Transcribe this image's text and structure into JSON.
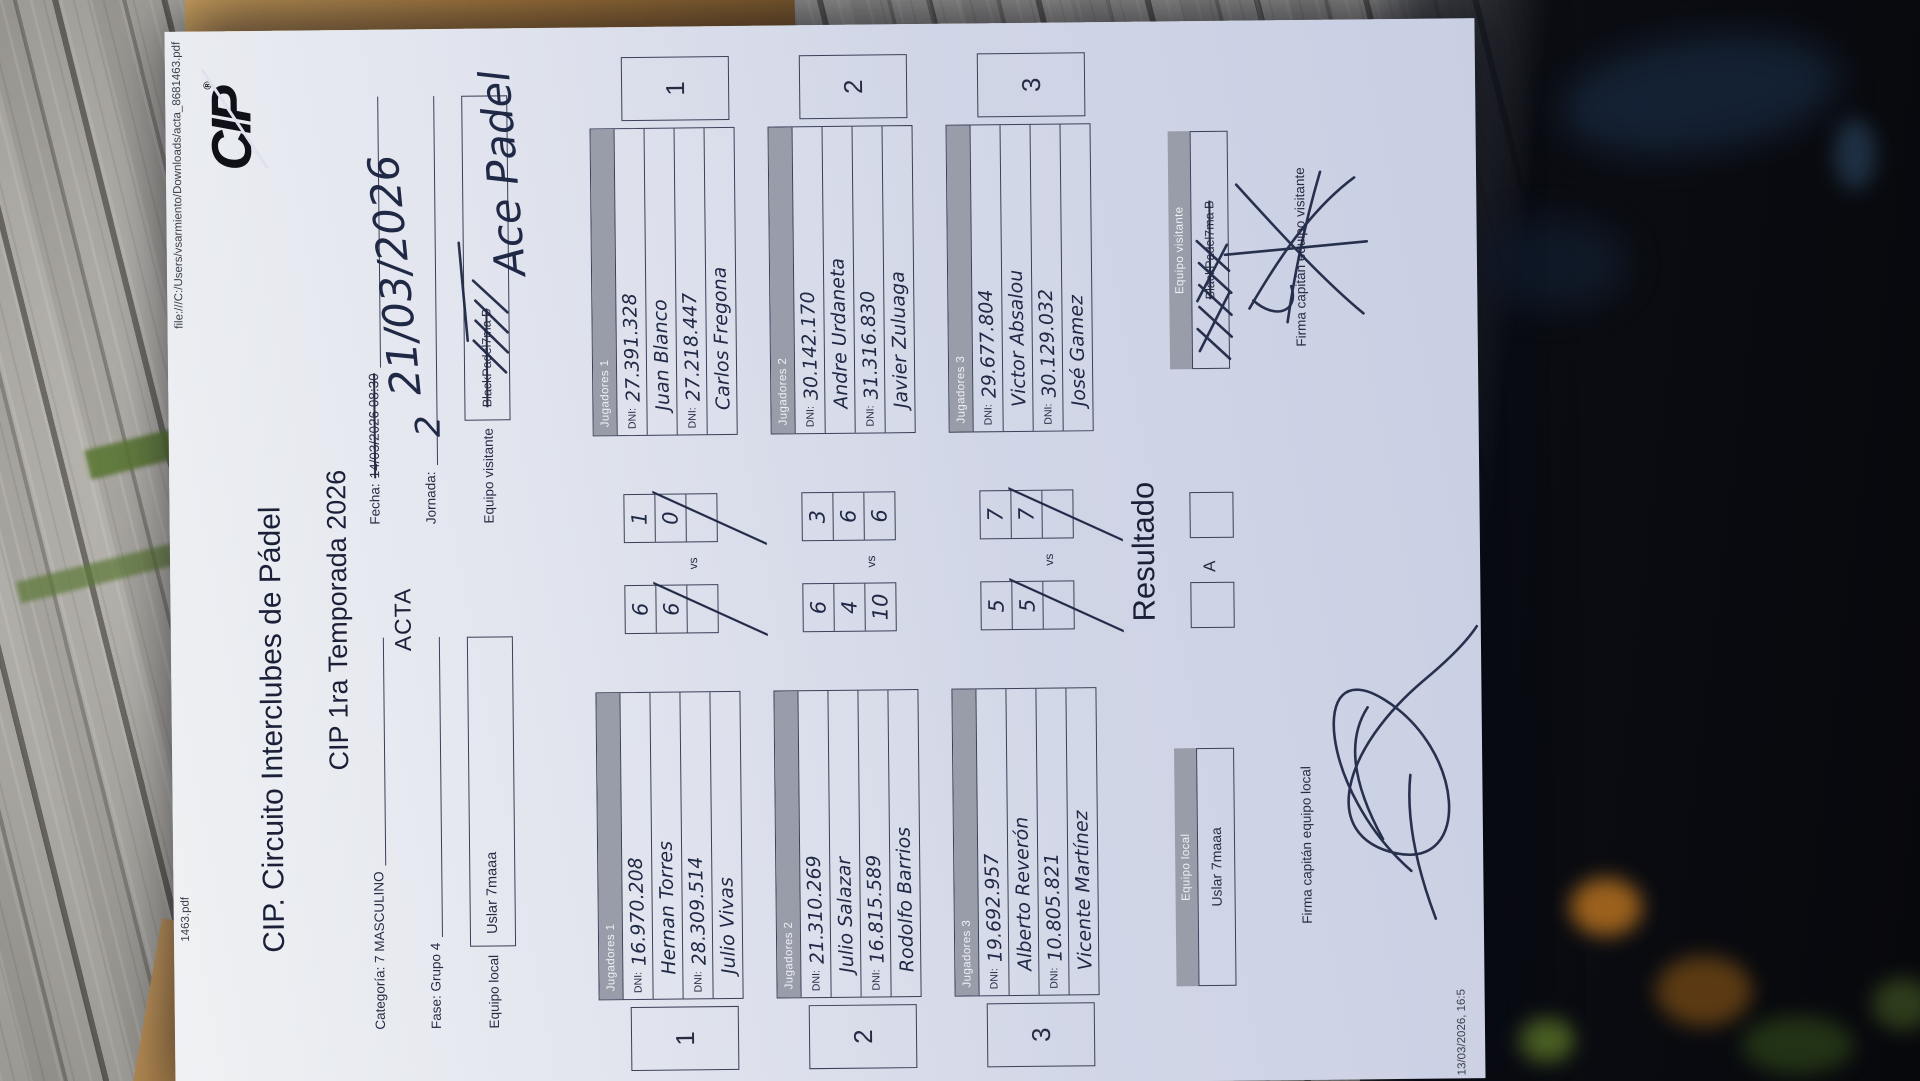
{
  "print_header": {
    "left": "1463.pdf",
    "right": "file:///C:/Users/vsarmiento/Downloads/acta_8681463.pdf"
  },
  "print_footer": {
    "left": "13/03/2026, 16:5"
  },
  "logo": {
    "text": "CIP",
    "registered": "®"
  },
  "header": {
    "title": "CIP. Circuito Interclubes de Pádel",
    "subtitle": "CIP 1ra Temporada 2026",
    "acta": "ACTA"
  },
  "fields": {
    "categoria_label": "Categoría: 7 MASCULINO",
    "fase_label": "Fase: Grupo 4",
    "equipo_local_label": "Equipo local",
    "equipo_local_value": "Uslar 7maaa",
    "fecha_label": "Fecha:",
    "fecha_struck": "14/03/2026 08:30",
    "fecha_handwritten": "21/03/2026",
    "jornada_label": "Jornada:",
    "jornada_value": "2",
    "equipo_visitante_label": "Equipo visitante",
    "equipo_visitante_struck": "BlackPadel7ma B",
    "equipo_visitante_handwritten": "Ace Padel"
  },
  "labels": {
    "dni": "DNI:",
    "vs": "vs"
  },
  "matches": [
    {
      "number": "1",
      "header": "Jugadores 1",
      "local_players": [
        {
          "dni": "16.970.208",
          "name": "Hernan Torres"
        },
        {
          "dni": "28.309.514",
          "name": "Julio Vivas"
        }
      ],
      "visitor_players": [
        {
          "dni": "27.391.328",
          "name": "Juan Blanco"
        },
        {
          "dni": "27.218.447",
          "name": "Carlos Fregona"
        }
      ],
      "local_sets": [
        "6",
        "6",
        ""
      ],
      "visitor_sets": [
        "1",
        "0",
        ""
      ]
    },
    {
      "number": "2",
      "header": "Jugadores 2",
      "local_players": [
        {
          "dni": "21.310.269",
          "name": "Julio Salazar"
        },
        {
          "dni": "16.815.589",
          "name": "Rodolfo Barrios"
        }
      ],
      "visitor_players": [
        {
          "dni": "30.142.170",
          "name": "Andre Urdaneta"
        },
        {
          "dni": "31.316.830",
          "name": "Javier Zuluaga"
        }
      ],
      "local_sets": [
        "6",
        "4",
        "10"
      ],
      "visitor_sets": [
        "3",
        "6",
        "6"
      ]
    },
    {
      "number": "3",
      "header": "Jugadores 3",
      "local_players": [
        {
          "dni": "19.692.957",
          "name": "Alberto Reverón"
        },
        {
          "dni": "10.805.821",
          "name": "Vicente Martínez"
        }
      ],
      "visitor_players": [
        {
          "dni": "29.677.804",
          "name": "Victor Absalou"
        },
        {
          "dni": "30.129.032",
          "name": "José Gamez"
        }
      ],
      "local_sets": [
        "5",
        "5",
        ""
      ],
      "visitor_sets": [
        "7",
        "7",
        ""
      ]
    }
  ],
  "resultado": {
    "title": "Resultado",
    "option_label": "A",
    "local_bar": "Equipo local",
    "local_value": "Uslar 7maaa",
    "visitor_bar": "Equipo visitante",
    "visitor_struck": "BlackPadel7ma B",
    "firma_local": "Firma capitán equipo local",
    "firma_visitante": "Firma capitán equipo visitante"
  },
  "palette": {
    "ink": "#1f2845",
    "print": "#272c44",
    "bar_gray": "#989da9",
    "paper": "#d1d6e7"
  }
}
